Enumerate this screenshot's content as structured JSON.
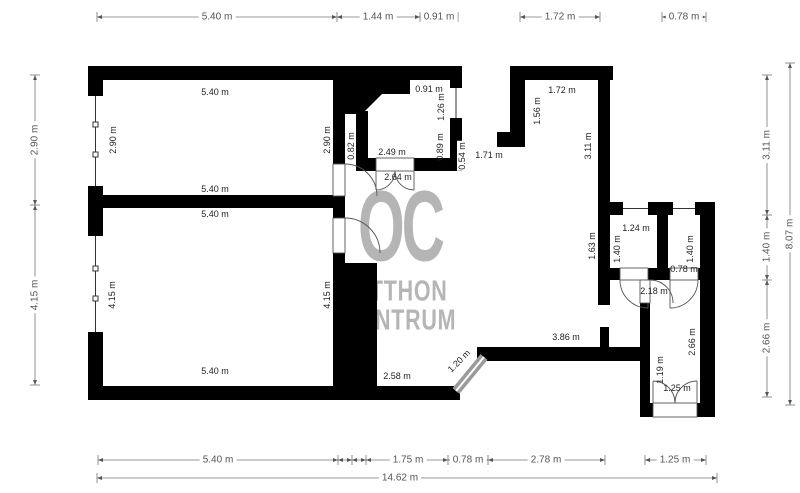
{
  "watermark": {
    "logo": "OC",
    "line1": "OTTHON",
    "line2": "CENTRUM"
  },
  "dimensions": {
    "top": [
      "5.40 m",
      "1.44 m",
      "0.91 m",
      "1.72 m",
      "0.78 m"
    ],
    "bottom": [
      "5.40 m",
      "1.75 m",
      "0.78 m",
      "2.78 m",
      "1.25 m"
    ],
    "bottom_total": "14.62 m",
    "left": [
      "2.90 m",
      "4.15 m"
    ],
    "right": [
      "3.11 m",
      "1.40 m",
      "2.66 m"
    ],
    "right_total": "8.07 m"
  },
  "interior_labels": {
    "room1_top": "5.40 m",
    "room1_left": "2.90 m",
    "room1_right": "2.90 m",
    "room1_bottom": "5.40 m",
    "room2_top": "5.40 m",
    "room2_left": "4.15 m",
    "room2_right": "4.15 m",
    "room2_bottom": "5.40 m",
    "room1_door": "0.82 m",
    "vestibule_top": "0.91 m",
    "vestibule_window": "1.26 m",
    "vestibule_width": "2.49 m",
    "vestibule_width2": "2.64 m",
    "vestibule_wall": "0.89 m",
    "passage_wall": "0.54 m",
    "passage": "1.71 m",
    "hall_top": "1.72 m",
    "hall_left": "1.56 m",
    "hall_right": "3.11 m",
    "hall_wall": "1.63 m",
    "hall_bottom": "3.86 m",
    "bath_width": "1.24 m",
    "bath_height": "1.40 m",
    "wc_height": "1.40 m",
    "wc_width": "0.78 m",
    "corridor2_width": "2.18 m",
    "room3_height": "2.66 m",
    "room3_seg": "1.19 m",
    "room3_door": "1.25 m",
    "corridor_width": "2.58 m",
    "corridor_diag": "1.20 m"
  }
}
